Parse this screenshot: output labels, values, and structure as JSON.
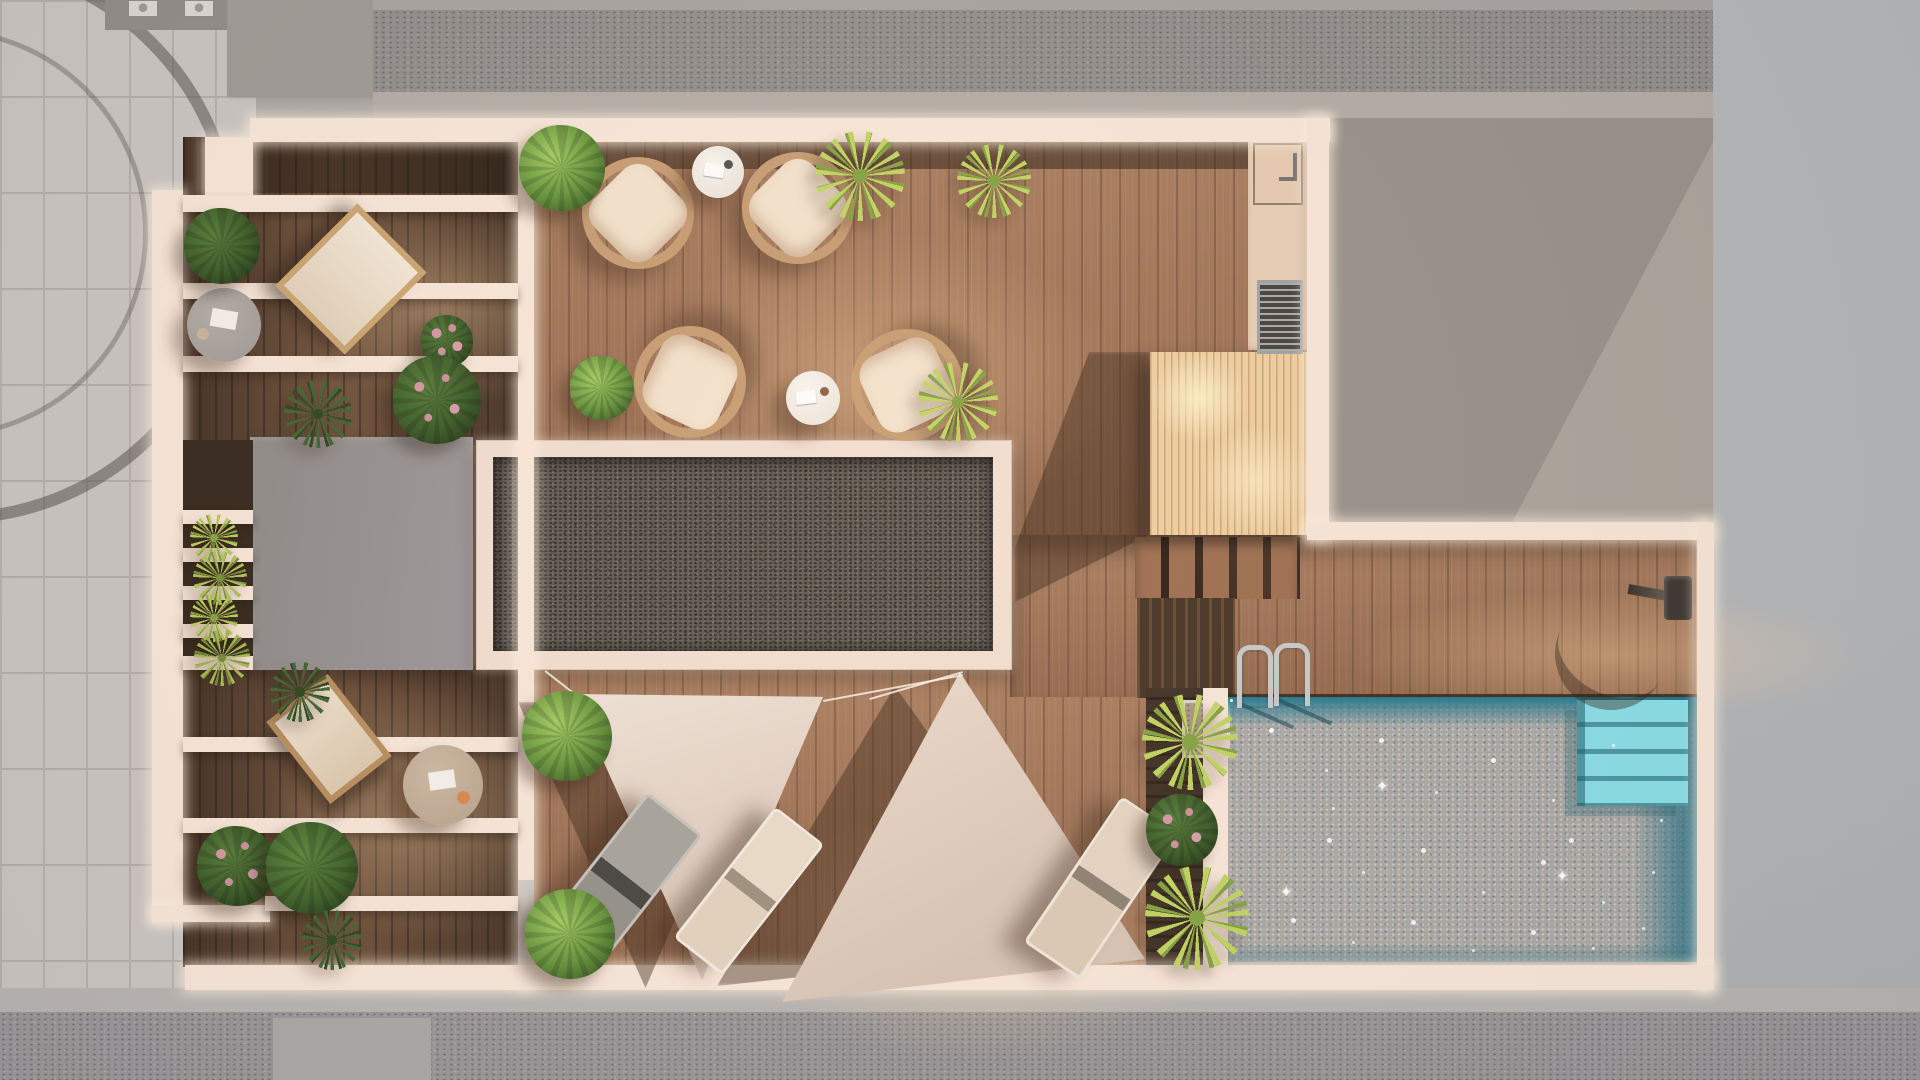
{
  "scene": {
    "title": "rooftop-terrace-top-view-render",
    "areas": [
      "street-paving",
      "neighbor-roofs",
      "balcony-wing",
      "main-deck",
      "skylight",
      "outdoor-kitchen",
      "pergola-platform",
      "stairs",
      "pool-deck",
      "swimming-pool",
      "shade-sail-lounge"
    ],
    "furniture_counts": {
      "rattan_chairs": 4,
      "white_side_tables": 2,
      "deck_chairs": 2,
      "round_low_tables": 2,
      "sun_loungers": 3,
      "shade_sails": 2
    },
    "pool": {
      "sparkle_glyph": "✦",
      "has_ladder": true,
      "has_corner_steps": true,
      "has_outdoor_shower": true
    }
  },
  "palette": {
    "bg": "#a9a6a3",
    "paving": "#c9c5c2",
    "wall": "#f9e8da",
    "wood-main": "#9c6e50",
    "wood-wing": "#5a3e2b",
    "skylight": "#5b544c",
    "graybox": "#908d8a",
    "trbuild": "#958f88",
    "rightbuild": "#b3b6b9",
    "roofband": "#8f8c8a",
    "street": "#949396",
    "sidewalk": "#b6b3b1",
    "pool": "#46c6d8",
    "pool-deep": "#19758d",
    "pool-step": "#86e0ea",
    "pergola": "#f0cf9f",
    "counter": "#e9cfb6",
    "rattan": "#c59a6f",
    "cushion": "#f4e3cd",
    "sailcloth": "#e9dbcd"
  }
}
